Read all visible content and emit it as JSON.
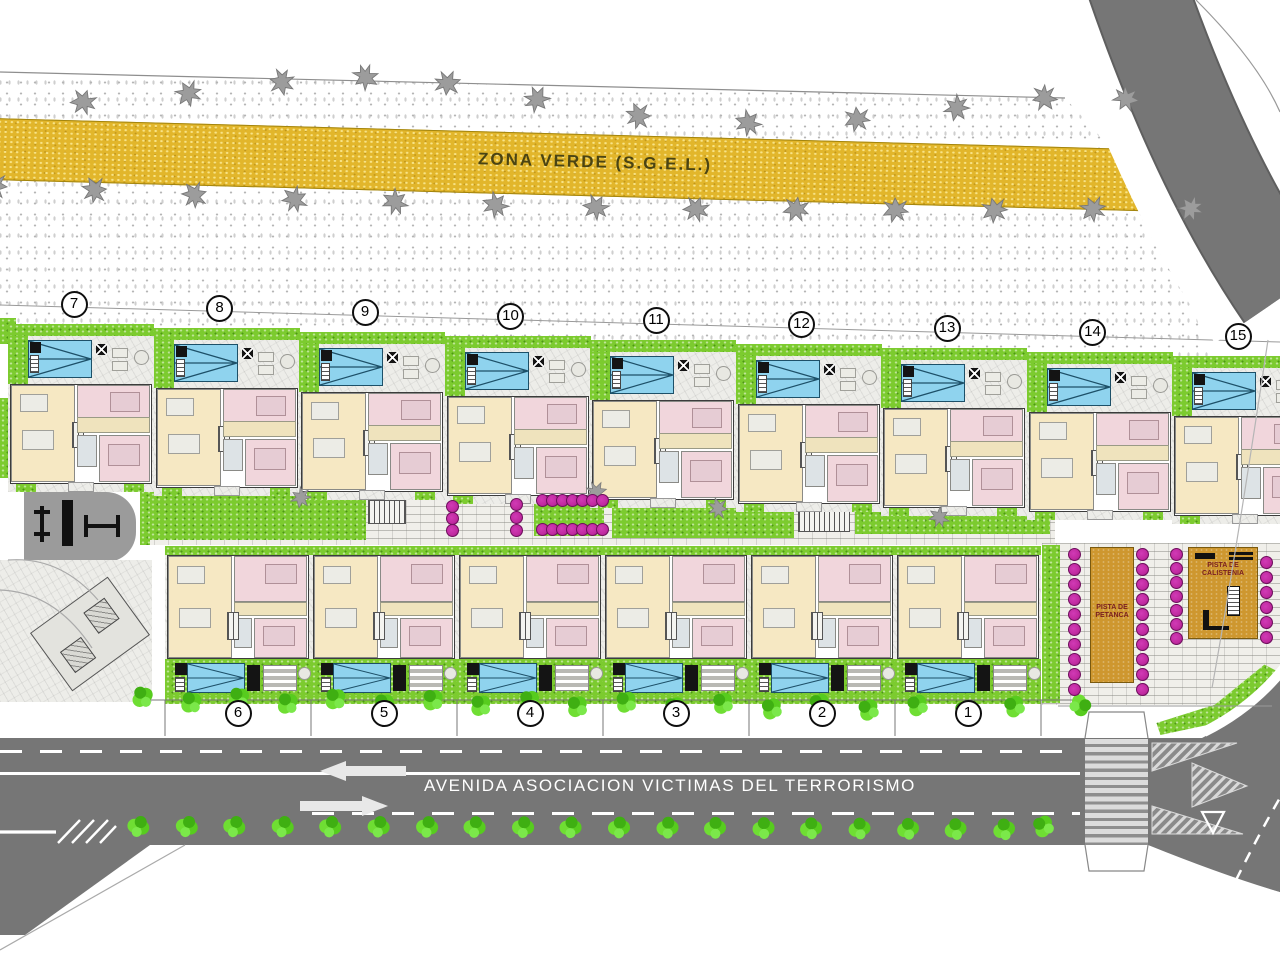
{
  "plan": {
    "zona_verde_label": "ZONA VERDE (S.G.E.L.)",
    "avenue_name": "AVENIDA ASOCIACION VICTIMAS DEL TERRORISMO",
    "petanca_label": "PISTA DE PETANCA",
    "calistenia_label": "PISTA DE CALISTENIA",
    "top_row_plots": [
      "7",
      "8",
      "9",
      "10",
      "11",
      "12",
      "13",
      "14",
      "15"
    ],
    "bottom_row_plots": [
      "6",
      "5",
      "4",
      "3",
      "2",
      "1"
    ],
    "colors": {
      "zona_verde": "#E2B62B",
      "road": "#767676",
      "lawn": "#7CCB2F",
      "pool": "#8FD3EE",
      "living": "#F6E8C3",
      "bedroom": "#F1D6DC",
      "flower": "#C02AA0",
      "court": "#CE972F"
    }
  }
}
